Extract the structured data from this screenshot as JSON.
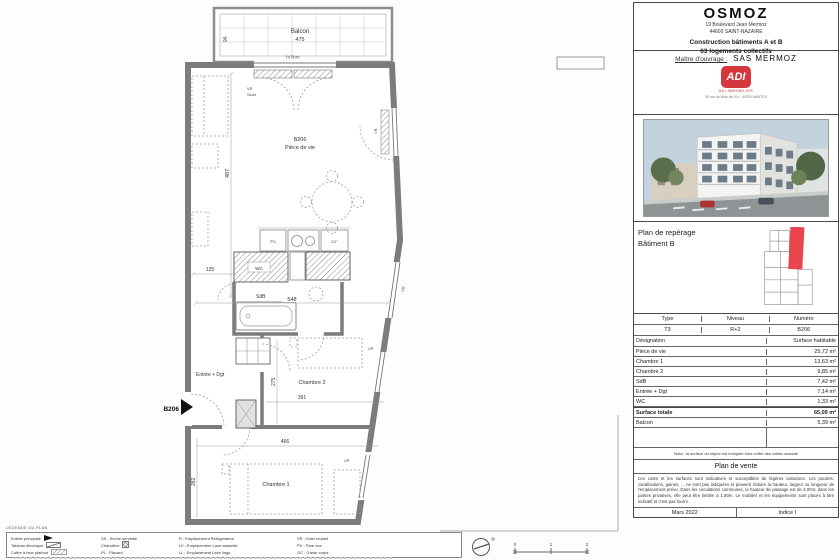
{
  "plan": {
    "balcony": {
      "label": "Balcon",
      "dim": "475",
      "side_dim": "94",
      "ht_libre": "ht libre"
    },
    "door_note": {
      "vr": "VR",
      "seuil": "Seuil"
    },
    "rooms": {
      "living_code": "B206",
      "living": "Pièce de vie",
      "wc": "WC",
      "sdb": "SdB",
      "entree": "Entrée + Dgt",
      "chambre2": "Chambre 2",
      "chambre1": "Chambre 1"
    },
    "entry_tag": "B206",
    "window_tag": "VR",
    "kitchen": {
      "fo": "Fo",
      "lv": "LV"
    },
    "dims": {
      "w_living": "548",
      "h_living": "487",
      "w_125": "125",
      "w_391": "391",
      "h_275": "275",
      "w_466": "466",
      "h_282": "282"
    },
    "scale_ticks": [
      "0",
      "1",
      "2"
    ]
  },
  "legend": {
    "title": "LEGENDE DU PLAN",
    "col1": [
      "Entrée principale",
      "Tableau électrique",
      "Coffre à faux plafond"
    ],
    "col2": [
      "SS : Sèche serviette",
      "Chaudière",
      "PL : Placard"
    ],
    "col3": [
      "R : Emplacement Réfrigérateur",
      "LV : Emplacement Lave vaisselle",
      "LL : Emplacement Lave linge"
    ],
    "col4": [
      "VR : Volet roulant",
      "PV : Pare vue",
      "GC : Garde corps"
    ]
  },
  "panel": {
    "title": "OSMOZ",
    "address_line1": "19 Boulevard Jean Mermoz",
    "address_line2": "44600 SAINT-NAZAIRE",
    "project_line1": "Construction bâtiments A et B",
    "project_line2": "63 logements collectifs",
    "client_label": "Maître d'ouvrage :",
    "client_name": "SAS MERMOZ",
    "logo": {
      "text": "ADI",
      "tagline": "ADI IMMOBILIER",
      "address": "30 rue du Bois de l'Or - 44300 NANTES"
    },
    "reperage": {
      "line1": "Plan de repérage",
      "line2": "Bâtiment B"
    },
    "table": {
      "header": [
        "Type",
        "Niveau",
        "Numéro"
      ],
      "unit": [
        "T3",
        "R+2",
        "B206"
      ],
      "columns": [
        "Désignation",
        "Surface habitable"
      ],
      "rows": [
        [
          "Pièce de vie",
          "25,72 m²"
        ],
        [
          "Chambre 1",
          "13,63 m²"
        ],
        [
          "Chambre 2",
          "9,85 m²"
        ],
        [
          "SdB",
          "7,42 m²"
        ],
        [
          "Entrée + Dgt",
          "7,14 m²"
        ],
        [
          "WC",
          "1,33 m²"
        ]
      ],
      "total": [
        "Surface totale",
        "65,09 m²"
      ],
      "balcony": [
        "Balcon",
        "5,39 m²"
      ]
    },
    "nota": "Nota : la surface du séjour est indiquée hors coffre des volets roulants",
    "sale_title": "Plan de vente",
    "disclaimer": "Les cotes et les surfaces sont indicatives et susceptibles de légères variations. Les poutres, canalisations, gaines, ... ne sont pas indiquées et peuvent réduire la hauteur, largeur ou longueur de l'emplacement prévu. Dans les circulations communes, la hauteur de passage est de 2,00m; dans les parties privatives, elle peut être limitée à 1,80m. Le mobilier et les équipements sont placés à titre indicatif et n'est pas fourni.",
    "date": "Mars 2022",
    "indice": "Indice I"
  }
}
